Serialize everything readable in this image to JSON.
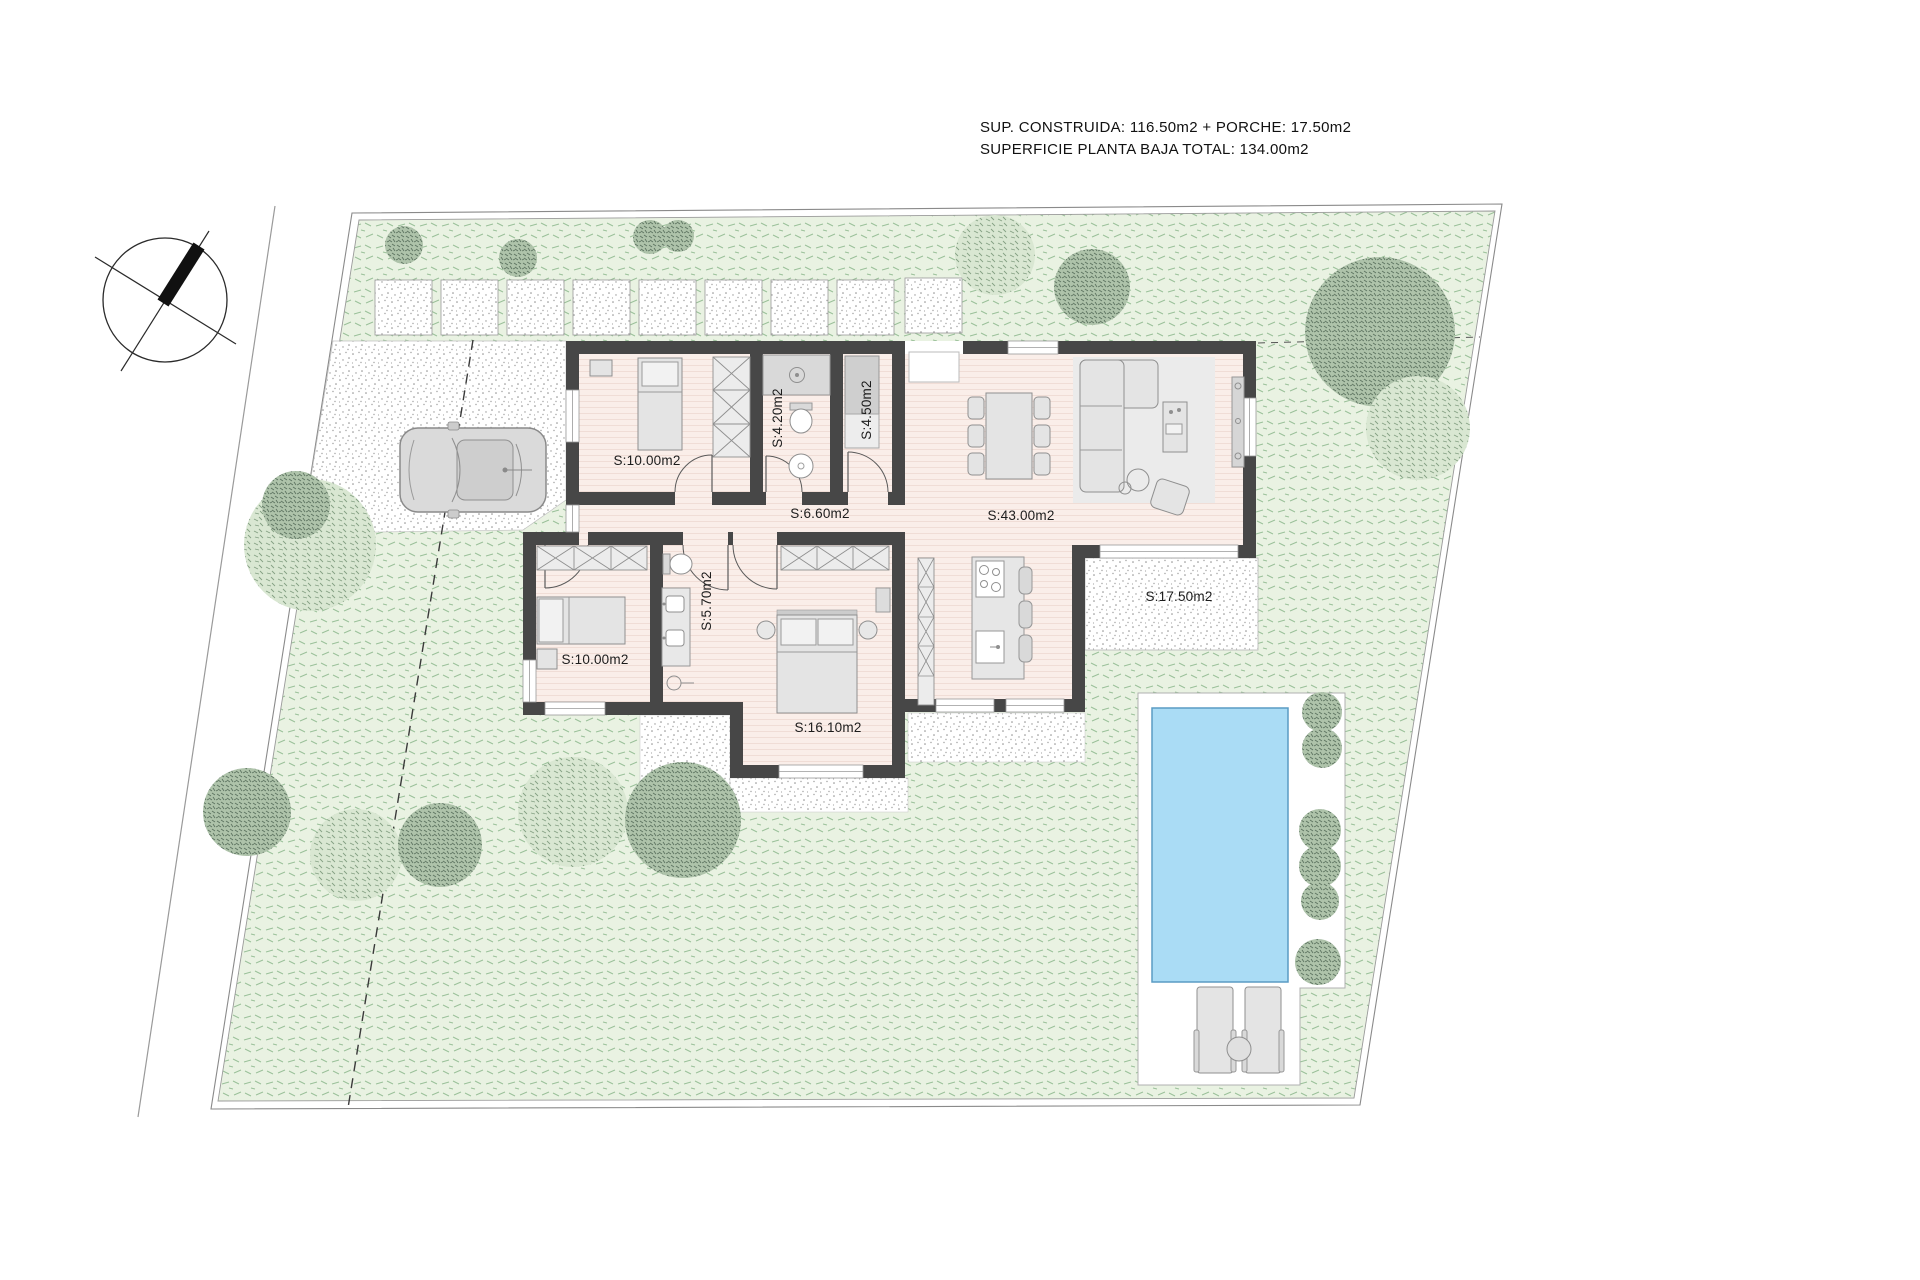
{
  "annotation": {
    "line1": "SUP. CONSTRUIDA: 116.50m2 + PORCHE: 17.50m2",
    "line2": "SUPERFICIE PLANTA BAJA TOTAL: 134.00m2"
  },
  "rooms": [
    {
      "id": "bedroom-1",
      "area_label": "S:10.00m2"
    },
    {
      "id": "bathroom-1",
      "area_label": "S:4.20m2"
    },
    {
      "id": "laundry-bath",
      "area_label": "S:4.50m2"
    },
    {
      "id": "hallway",
      "area_label": "S:6.60m2"
    },
    {
      "id": "living-dining-kitchen",
      "area_label": "S:43.00m2"
    },
    {
      "id": "porch",
      "area_label": "S:17.50m2"
    },
    {
      "id": "bedroom-2",
      "area_label": "S:10.00m2"
    },
    {
      "id": "bathroom-2",
      "area_label": "S:5.70m2"
    },
    {
      "id": "master-bedroom",
      "area_label": "S:16.10m2"
    }
  ],
  "colors": {
    "grass": "#e9f2e2",
    "floor": "#faeee9",
    "wall": "#474747",
    "pool_water": "#aadcf5",
    "pool_edge": "#5a9bc4",
    "tree_dark": "#5c7360",
    "tree_light": "#84a083"
  },
  "site_features": [
    "north-arrow",
    "plot-boundary",
    "driveway",
    "car",
    "stepping-stones",
    "garden-grass",
    "trees",
    "swimming-pool",
    "pool-deck",
    "sun-loungers",
    "porch-terrace",
    "house-floorplan"
  ]
}
